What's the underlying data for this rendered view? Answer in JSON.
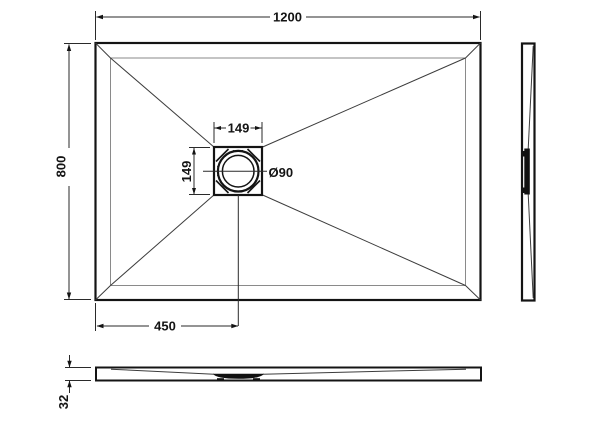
{
  "plan_view": {
    "width": "1200",
    "height": "800",
    "drain_offset_x": "450",
    "drain_square_width": "149",
    "drain_square_height": "149",
    "drain_diameter": "Ø90"
  },
  "front_view": {
    "thickness": "32"
  },
  "colors": {
    "outline": "#141414",
    "dimension_line": "#2a2a2a",
    "rim_line": "#8a8a8a",
    "crease_line": "#3c3c3c",
    "background": "#ffffff"
  }
}
